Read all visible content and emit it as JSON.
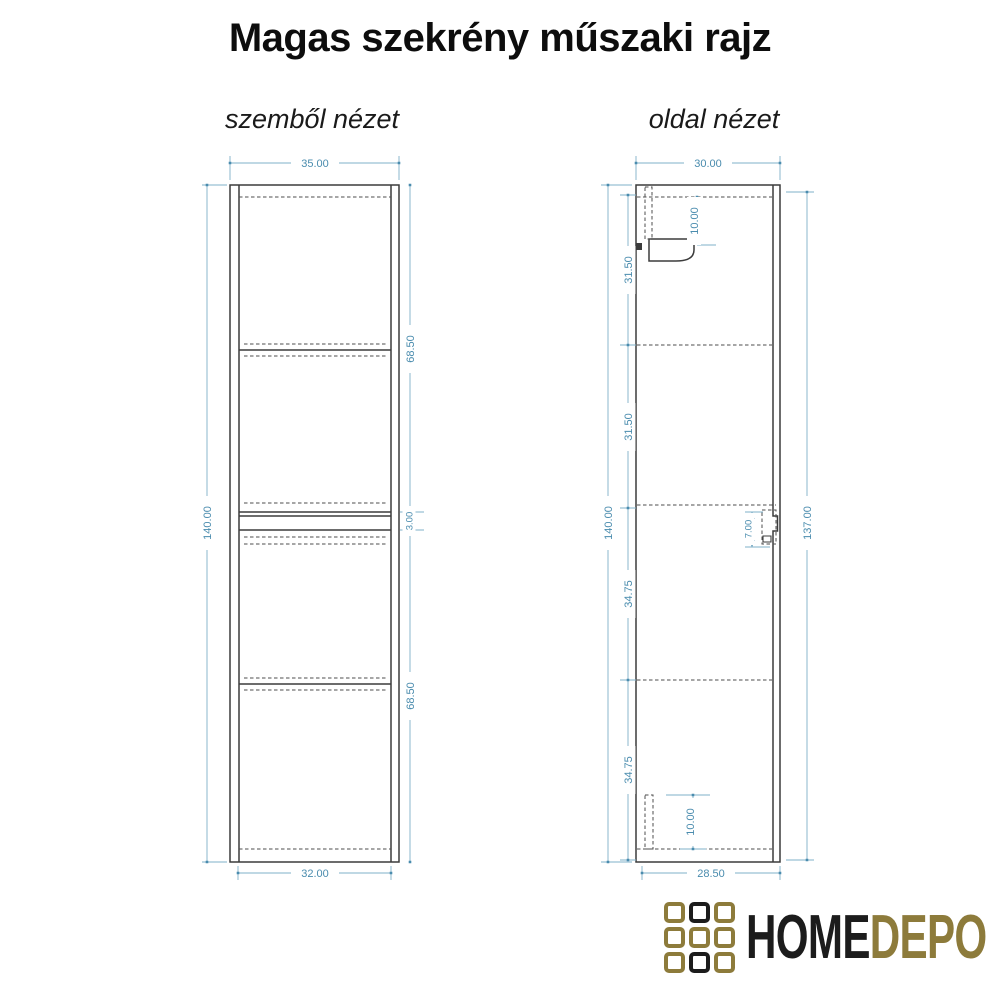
{
  "title": "Magas szekrény műszaki rajz",
  "views": {
    "front": {
      "label": "szemből nézet",
      "dims": {
        "top_width": "35.00",
        "height": "140.00",
        "upper_section": "68.50",
        "middle_gap": "3.00",
        "lower_section": "68.50",
        "bottom_width": "32.00"
      }
    },
    "side": {
      "label": "oldal nézet",
      "dims": {
        "top_width": "30.00",
        "height": "140.00",
        "segment_1": "31.50",
        "segment_2": "31.50",
        "segment_3": "34.75",
        "segment_4": "34.75",
        "top_bracket": "10.00",
        "middle_bracket": "7.00",
        "bottom_bracket": "10.00",
        "right_height": "137.00",
        "bottom_width": "28.50"
      }
    }
  },
  "drawing_colors": {
    "outline": "#3c3c3c",
    "hidden_line": "#4d4d4d",
    "dimension_text": "#4a8cae",
    "dimension_line": "#7fb0c9"
  },
  "logo": {
    "text_primary": "HOME",
    "text_secondary": "DEPO",
    "grid": [
      "gold",
      "black",
      "gold",
      "gold",
      "gold",
      "gold",
      "gold",
      "black",
      "gold"
    ],
    "colors": {
      "gold": "#8d7b3b",
      "black": "#1c1c1c"
    }
  }
}
